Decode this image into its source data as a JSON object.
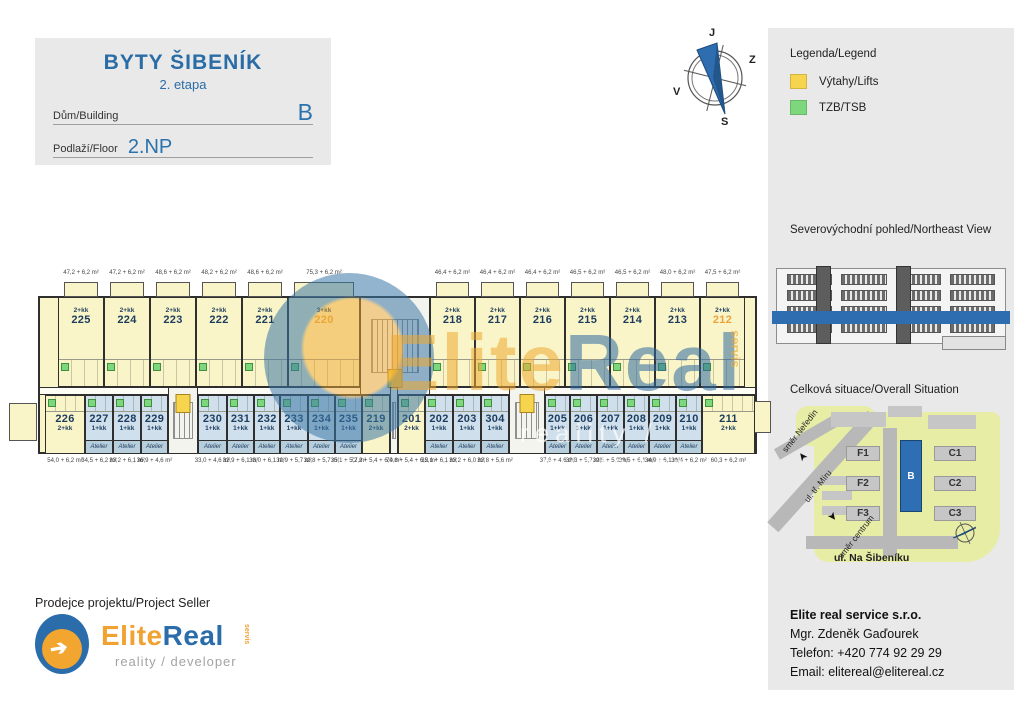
{
  "header": {
    "title": "BYTY ŠIBENÍK",
    "subtitle": "2. etapa",
    "building_label": "Dům/Building",
    "building_value": "B",
    "floor_label": "Podlaží/Floor",
    "floor_value": "2.NP"
  },
  "compass": {
    "top": "J",
    "right": "Z",
    "left": "V",
    "bottom": "S"
  },
  "legend": {
    "title": "Legenda/Legend",
    "items": [
      {
        "label": "Výtahy/Lifts",
        "color": "#F6D44D"
      },
      {
        "label": "TZB/TSB",
        "color": "#7DD77D"
      }
    ]
  },
  "northeast_view": {
    "title": "Severovýchodní pohled/Northeast View",
    "highlight_color": "#2D6DB0"
  },
  "situation": {
    "title": "Celková situace/Overall Situation",
    "buildings": [
      {
        "label": "F1"
      },
      {
        "label": "F2"
      },
      {
        "label": "F3"
      },
      {
        "label": "B",
        "highlight": true
      },
      {
        "label": "C1"
      },
      {
        "label": "C2"
      },
      {
        "label": "C3"
      }
    ],
    "street_main": "ul. Na Šibeníku",
    "street_diag": "ul. tř. Míru",
    "dir_nw": "směr Neředín",
    "dir_se": "směr centrum",
    "arrow_glyph": "➤"
  },
  "watermark": {
    "part1": "Elite",
    "part2": "Real",
    "servis": "servis",
    "tagline": "reality / developer"
  },
  "seller": {
    "heading": "Prodejce projektu/Project Seller",
    "logo": {
      "part1": "Elite",
      "part2": "Real",
      "servis": "servis",
      "tagline": "reality / developer",
      "arrow_glyph": "➔"
    }
  },
  "contact": {
    "company": "Elite real service s.r.o.",
    "person": "Mgr. Zdeněk Gaďourek",
    "phone": "Telefon: +420 774 92 29 29",
    "email": "Email: elitereal@elitereal.cz"
  },
  "floorplan": {
    "atelier_label": "Atelier",
    "colors": {
      "unit_yellow": "#FAF5C8",
      "atelier_blue": "#CFDFEB",
      "lift_yellow": "#F6D44D",
      "tzb_green": "#7DD77D",
      "number_navy": "#1C3C5E",
      "number_orange": "#EAA23C"
    },
    "top_units": [
      {
        "no": "225",
        "type": "2+kk",
        "area": "47,2 + 6,2 m²",
        "x": 20,
        "w": 46
      },
      {
        "no": "224",
        "type": "2+kk",
        "area": "47,2 + 6,2 m²",
        "x": 66,
        "w": 46
      },
      {
        "no": "223",
        "type": "2+kk",
        "area": "48,6 + 6,2 m²",
        "x": 112,
        "w": 46
      },
      {
        "no": "222",
        "type": "2+kk",
        "area": "48,2 + 6,2 m²",
        "x": 158,
        "w": 46
      },
      {
        "no": "221",
        "type": "2+kk",
        "area": "48,6 + 6,2 m²",
        "x": 204,
        "w": 46
      },
      {
        "no": "220",
        "type": "3+kk",
        "area": "75,3 + 6,2 m²",
        "x": 250,
        "w": 72,
        "highlight": true
      },
      {
        "no": "218",
        "type": "2+kk",
        "area": "46,4 + 6,2 m²",
        "x": 392,
        "w": 45
      },
      {
        "no": "217",
        "type": "2+kk",
        "area": "46,4 + 6,2 m²",
        "x": 437,
        "w": 45
      },
      {
        "no": "216",
        "type": "2+kk",
        "area": "46,4 + 6,2 m²",
        "x": 482,
        "w": 45
      },
      {
        "no": "215",
        "type": "2+kk",
        "area": "46,5 + 6,2 m²",
        "x": 527,
        "w": 45
      },
      {
        "no": "214",
        "type": "2+kk",
        "area": "46,5 + 6,2 m²",
        "x": 572,
        "w": 45
      },
      {
        "no": "213",
        "type": "2+kk",
        "area": "48,0 + 6,2 m²",
        "x": 617,
        "w": 45
      },
      {
        "no": "212",
        "type": "2+kk",
        "area": "47,5 + 6,2 m²",
        "x": 662,
        "w": 45,
        "highlight": true
      }
    ],
    "bottom_units": [
      {
        "no": "226",
        "type": "2+kk",
        "area": "54,0 + 6,2 m²",
        "x": 7,
        "w": 40,
        "flat": true
      },
      {
        "no": "227",
        "type": "1+kk",
        "area": "34,5 + 6,2 m²",
        "x": 47,
        "w": 28,
        "atelier": true
      },
      {
        "no": "228",
        "type": "1+kk",
        "area": "33,2 + 6,1 m²",
        "x": 75,
        "w": 28,
        "atelier": true
      },
      {
        "no": "229",
        "type": "1+kk",
        "area": "36,9 + 4,6 m²",
        "x": 103,
        "w": 27,
        "atelier": true
      },
      {
        "no": "230",
        "type": "1+kk",
        "area": "33,0 + 4,6 m²",
        "x": 160,
        "w": 29,
        "atelier": true
      },
      {
        "no": "231",
        "type": "1+kk",
        "area": "32,9 + 6,1 m²",
        "x": 189,
        "w": 27,
        "atelier": true
      },
      {
        "no": "232",
        "type": "1+kk",
        "area": "33,0 + 6,1 m²",
        "x": 216,
        "w": 26,
        "atelier": true
      },
      {
        "no": "233",
        "type": "1+kk",
        "area": "32,9 + 5,7 m²",
        "x": 242,
        "w": 28,
        "atelier": true
      },
      {
        "no": "234",
        "type": "1+kk",
        "area": "32,8 + 5,7 m²",
        "x": 270,
        "w": 27,
        "atelier": true
      },
      {
        "no": "235",
        "type": "1+kk",
        "area": "35,1 + 5,7 m²",
        "x": 297,
        "w": 27,
        "atelier": true
      },
      {
        "no": "219",
        "type": "2+kk",
        "area": "72,2 + 5,4 + 6,0 m²",
        "x": 324,
        "w": 28,
        "flat": true
      },
      {
        "no": "201",
        "type": "2+kk",
        "area": "74,8 + 5,4 + 6,2 m²",
        "x": 360,
        "w": 27,
        "flat": true
      },
      {
        "no": "202",
        "type": "1+kk",
        "area": "35,1 + 6,1 m²",
        "x": 387,
        "w": 28,
        "atelier": true
      },
      {
        "no": "203",
        "type": "1+kk",
        "area": "33,2 + 6,0 m²",
        "x": 415,
        "w": 28,
        "atelier": true
      },
      {
        "no": "304",
        "type": "1+kk",
        "area": "32,8 + 5,6 m²",
        "x": 443,
        "w": 28,
        "atelier": true
      },
      {
        "no": "205",
        "type": "1+kk",
        "area": "37,6 + 4,6 m²",
        "x": 507,
        "w": 25,
        "atelier": true
      },
      {
        "no": "206",
        "type": "1+kk",
        "area": "33,3 + 5,7 m²",
        "x": 532,
        "w": 27,
        "atelier": true
      },
      {
        "no": "207",
        "type": "1+kk",
        "area": "32,5 + 5,9 m²",
        "x": 559,
        "w": 27,
        "atelier": true
      },
      {
        "no": "208",
        "type": "1+kk",
        "area": "33,5 + 6,1 m²",
        "x": 586,
        "w": 25,
        "atelier": true
      },
      {
        "no": "209",
        "type": "1+kk",
        "area": "34,9 + 6,1 m²",
        "x": 611,
        "w": 27,
        "atelier": true
      },
      {
        "no": "210",
        "type": "1+kk",
        "area": "31,4 + 6,2 m²",
        "x": 638,
        "w": 26,
        "atelier": true
      },
      {
        "no": "211",
        "type": "2+kk",
        "area": "60,3 + 6,2 m²",
        "x": 664,
        "w": 53,
        "flat": true
      }
    ],
    "cores": [
      {
        "row": "top",
        "x": 322,
        "w": 70,
        "lift": true
      },
      {
        "row": "bottom",
        "x": 130,
        "w": 30,
        "lift": true
      },
      {
        "row": "bottom",
        "x": 352,
        "w": 8,
        "lift": false
      },
      {
        "row": "bottom",
        "x": 471,
        "w": 36,
        "lift": true
      }
    ]
  }
}
